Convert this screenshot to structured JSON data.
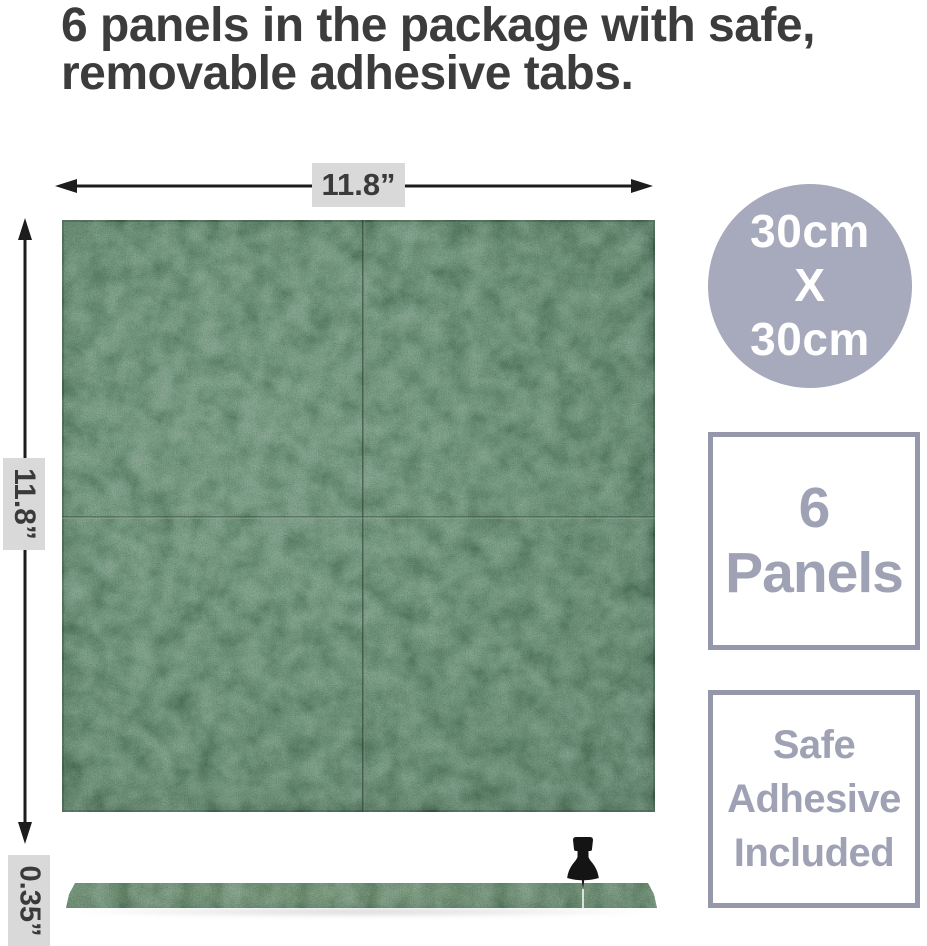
{
  "title": {
    "line1": "6 panels in the package with safe,",
    "line2": "removable adhesive tabs."
  },
  "dimensions": {
    "width_label": "11.8”",
    "height_label": "11.8”",
    "thickness_label": "0.35”"
  },
  "badges": {
    "size_circle": {
      "line1": "30cm",
      "line2": "X",
      "line3": "30cm"
    },
    "panel_count": {
      "line1": "6",
      "line2": "Panels"
    },
    "adhesive": {
      "line1": "Safe",
      "line2": "Adhesive",
      "line3": "Included"
    }
  },
  "colors": {
    "title_text": "#3c3c3c",
    "arrow": "#1c1c1c",
    "dimension_label_bg": "#d9d9d9",
    "dimension_label_text": "#3a3a3a",
    "panel_green": "#44624d",
    "strip_green": "#46614b",
    "circle_bg": "#a7a9bc",
    "badge_border": "#9598aa",
    "badge_text": "#9fa2b4",
    "badge_bg": "#ffffff",
    "white_text": "#ffffff"
  }
}
